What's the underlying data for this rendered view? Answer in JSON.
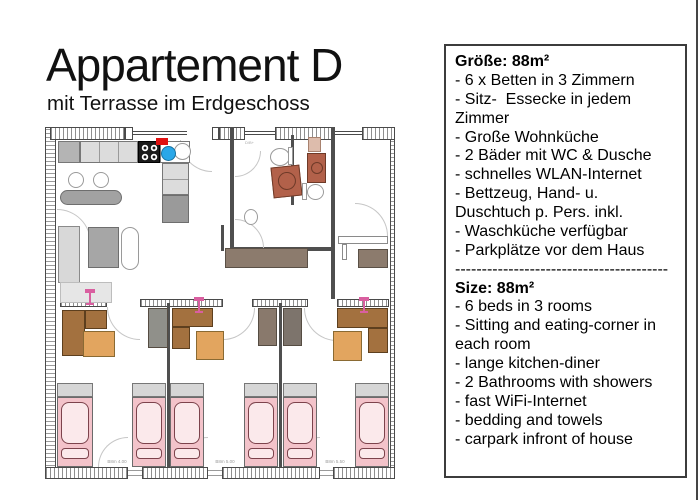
{
  "header": {
    "title": "Appartement D",
    "subtitle": "mit Terrasse im Erdgeschoss"
  },
  "info_panel": {
    "border_color": "#3c3c3c",
    "german": {
      "heading": "Größe: 88m²",
      "items": [
        "- 6 x Betten in 3 Zimmern",
        "- Sitz-  Essecke in jedem Zimmer",
        "- Große Wohnküche",
        "- 2 Bäder mit WC & Dusche",
        "- schnelles WLAN-Internet",
        "- Bettzeug, Hand- u. Duschtuch p. Pers. inkl.",
        "- Waschküche verfügbar",
        "- Parkplätze vor dem Haus"
      ]
    },
    "divider": "----------------------------------------",
    "english": {
      "heading": "Size: 88m²",
      "items": [
        "- 6 beds in 3 rooms",
        "- Sitting and eating-corner in each room",
        "- lange kitchen-diner",
        "- 2 Bathrooms with showers",
        "- fast WiFi-Internet",
        "- bedding and towels",
        "- carpark infront of house"
      ]
    }
  },
  "floor_plan": {
    "bath_label": "D/B+",
    "dimension_labels": [
      "B8m 4.00",
      "B8m 5.00",
      "B8m 5.50"
    ],
    "colors": {
      "bed_pink": "#f3c3ca",
      "mattress_pink": "#fbe9eb",
      "bench_brown": "#a3713f",
      "table_orange": "#e2a55f",
      "shower_terracotta": "#b2614a",
      "desk_brown": "#8c7b6d",
      "sink_blue": "#2aa7e8",
      "faucet_red": "#e01010",
      "plant_pink": "#d95fa0",
      "wall_gray": "#4f4f4f"
    }
  }
}
